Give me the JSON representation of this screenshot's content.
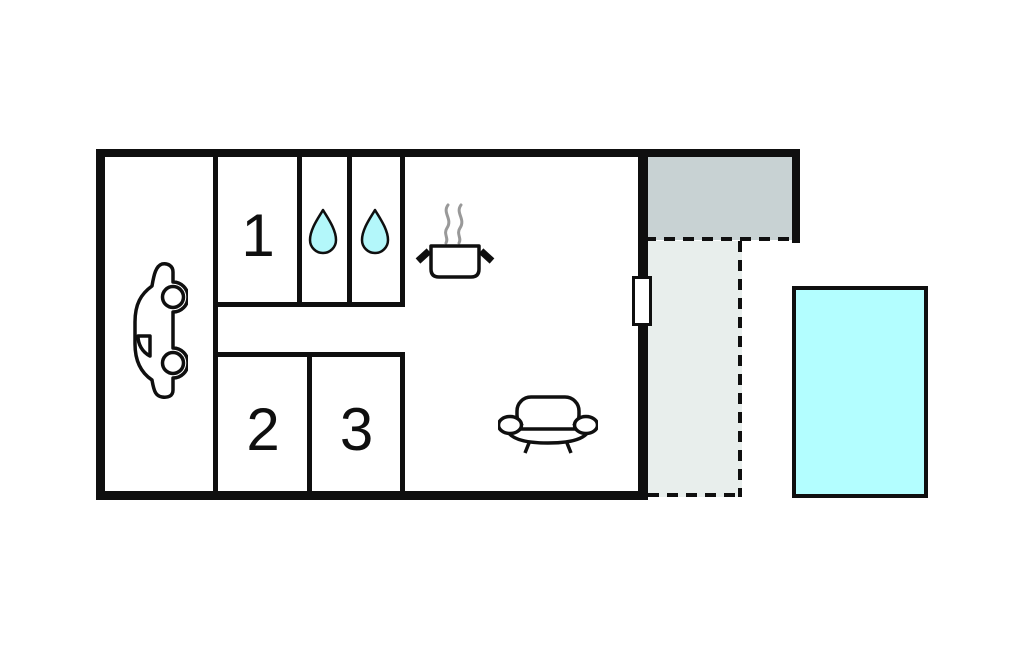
{
  "title": "holiday-home-floor-plan",
  "labels": {
    "room1": "1",
    "room2": "2",
    "room3": "3"
  },
  "rooms": [
    {
      "id": "garage",
      "icon": "car-icon"
    },
    {
      "id": "room-1",
      "label": "1"
    },
    {
      "id": "shower-room-a",
      "icon": "water-drop-icon"
    },
    {
      "id": "shower-room-b",
      "icon": "water-drop-icon"
    },
    {
      "id": "kitchen-living-area",
      "icons": [
        "cooking-pot-icon",
        "steam-icon",
        "sofa-icon"
      ]
    },
    {
      "id": "room-2",
      "label": "2"
    },
    {
      "id": "room-3",
      "label": "3"
    }
  ],
  "outdoor_areas": [
    {
      "id": "covered-porch",
      "style": "solid-gray",
      "fill": "#c8d2d3"
    },
    {
      "id": "terrace",
      "style": "dashed-outline",
      "fill": "#e8eeec"
    },
    {
      "id": "pool",
      "style": "solid-cyan",
      "fill": "#b3feff"
    }
  ],
  "features": [
    {
      "id": "door-window",
      "location": "right-wall"
    }
  ],
  "colors": {
    "background": "#ffffff",
    "wall": "#0f0f0f",
    "water_drop_fill": "#b3f7fa",
    "pool_fill": "#b3feff",
    "covered_porch_fill": "#c8d2d3",
    "terrace_fill": "#e8eeec",
    "steam_gray": "#999999"
  }
}
